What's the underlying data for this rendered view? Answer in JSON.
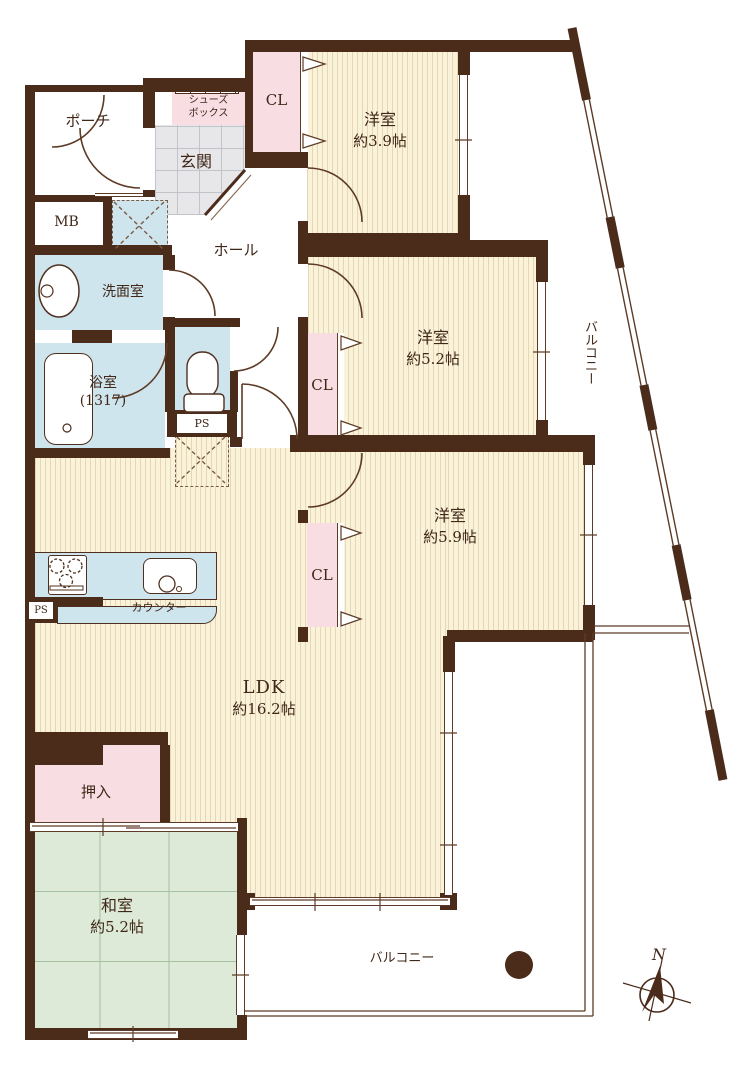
{
  "plan": {
    "labels": {
      "porch": "ポーチ",
      "entrance": "玄関",
      "shoe_box_line1": "シューズ",
      "shoe_box_line2": "ボックス",
      "hall": "ホール",
      "meter_box": "MB",
      "closet": "CL",
      "western_room": "洋室",
      "western_room_1_size": "約3.9帖",
      "western_room_2_size": "約5.2帖",
      "western_room_3_size": "約5.9帖",
      "washroom": "洗面室",
      "bathroom": "浴室",
      "bathroom_size": "(1317)",
      "pipe_space": "PS",
      "ldk": "LDK",
      "ldk_size": "約16.2帖",
      "counter": "カウンター",
      "oshiire": "押入",
      "japanese_room": "和室",
      "japanese_room_size": "約5.2帖",
      "balcony": "バルコニー",
      "compass_north": "N"
    },
    "colors": {
      "wall": "#4b2b1a",
      "line": "#5d3b26",
      "floor_wood": "#faf3da",
      "floor_tatami": "#dcead7",
      "floor_wet": "#cfe5ee",
      "closet_pink": "#f8dde3",
      "entrance_gray": "#e7e7ea",
      "text": "#402718"
    }
  }
}
